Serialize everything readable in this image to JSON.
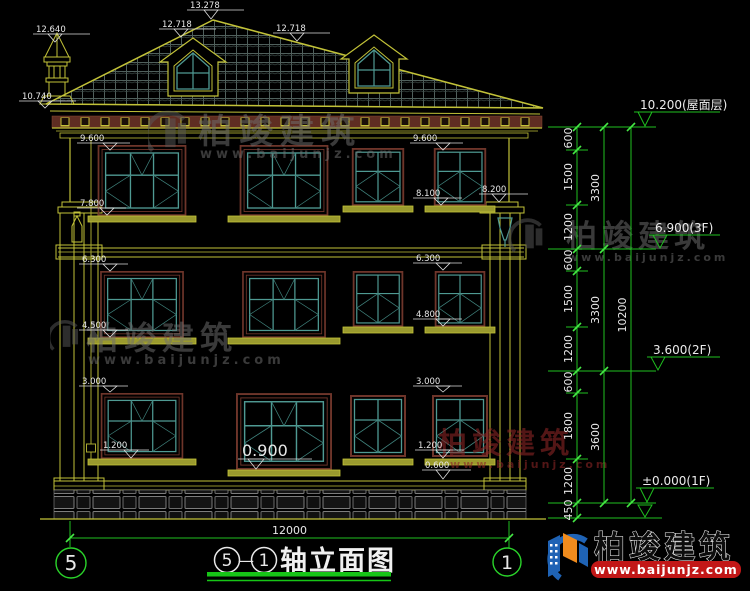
{
  "title": {
    "axis_left": "5",
    "dash": "—",
    "axis_right": "1",
    "text": "轴立面图"
  },
  "axis_bubbles": {
    "left": "5",
    "right": "1"
  },
  "watermark": {
    "brand": "柏竣建筑",
    "site": "www.baijunjz.com"
  },
  "logo": {
    "brand": "柏竣建筑",
    "site": "www.baijunjz.com"
  },
  "elevation_marks": {
    "ridge": "13.278",
    "chimney": "12.640",
    "dormer_left": "12.718",
    "dormer_right": "12.718",
    "eave_left": "10.740",
    "f3_head_left": "9.600",
    "f3_head_mid": "9.600",
    "f3_sill_left": "7.800",
    "f3_sill_right": "8.100",
    "pilaster_right": "8.200",
    "f2_head_left": "6.300",
    "f2_head_right": "6.300",
    "f2_sill_left": "4.500",
    "f2_sill_right": "4.800",
    "f1_head_left": "3.000",
    "f1_head_right": "3.000",
    "f1_sill_left": "1.200",
    "f1_sill_mid": "0.900",
    "f1_sill_right": "1.200",
    "base_trim": "0.600"
  },
  "levels": {
    "roof": "10.200(屋面层)",
    "f3": "6.900(3F)",
    "f2": "3.600(2F)",
    "f1": "±0.000(1F)"
  },
  "dims": {
    "bottom_total": "12000",
    "right_segments": [
      "600",
      "1500",
      "1200",
      "600",
      "1500",
      "1200",
      "600",
      "1800",
      "1200",
      "450"
    ],
    "right_floors": [
      "3300",
      "3300",
      "3600"
    ],
    "right_total": "10200"
  }
}
